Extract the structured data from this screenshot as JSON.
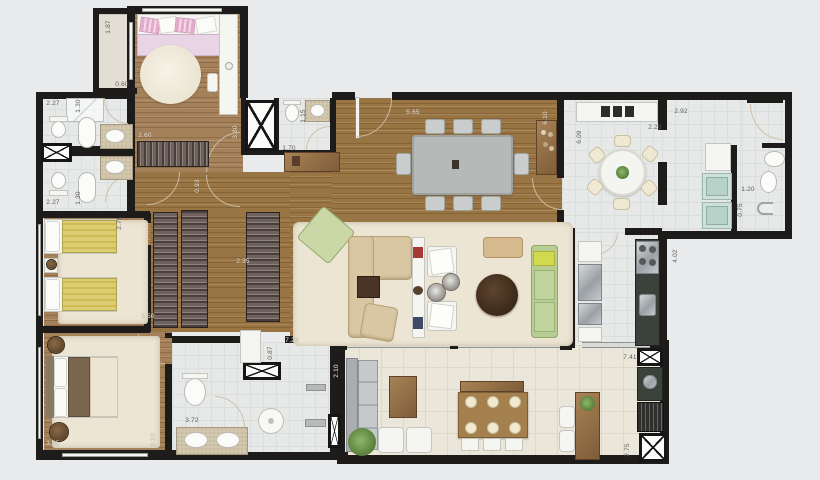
{
  "plan": {
    "title": "apartment-floor-plan-top-view",
    "palette": {
      "background": "#e9eaec",
      "wall": "#1d1c1a",
      "wood_floor": "#9a7544",
      "wood_floor_light": "#a5815a",
      "white_tile": "#e7e9e8",
      "terrace_tile": "#eae6da",
      "rug": "#ece5d4",
      "sofa_beige": "#d9c7a3",
      "sofa_green": "#b7cd92",
      "accent_yellow_blanket": "#dccc72",
      "accent_pink_blanket": "#e8d4e4",
      "counter_dark_granite": "#3b423b",
      "washer_teal": "#cfe0da",
      "wood_furniture": "#a07b4c"
    },
    "dimension_labels": [
      {
        "text": "1.87",
        "x": 109,
        "y": 27,
        "rot": "v",
        "on_dark": false
      },
      {
        "text": "0.60",
        "x": 122,
        "y": 85,
        "rot": "h",
        "on_dark": false
      },
      {
        "text": "2.27",
        "x": 53,
        "y": 104,
        "rot": "h",
        "on_dark": false
      },
      {
        "text": "1.30",
        "x": 79,
        "y": 106,
        "rot": "v",
        "on_dark": false
      },
      {
        "text": "2.60",
        "x": 145,
        "y": 136,
        "rot": "h",
        "on_dark": true
      },
      {
        "text": "3.80",
        "x": 236,
        "y": 132,
        "rot": "v",
        "on_dark": true
      },
      {
        "text": "0.93",
        "x": 198,
        "y": 186,
        "rot": "v",
        "on_dark": true
      },
      {
        "text": "2.27",
        "x": 53,
        "y": 203,
        "rot": "h",
        "on_dark": false
      },
      {
        "text": "1.30",
        "x": 79,
        "y": 198,
        "rot": "v",
        "on_dark": false
      },
      {
        "text": "2.71",
        "x": 120,
        "y": 223,
        "rot": "v",
        "on_dark": false
      },
      {
        "text": "2.35",
        "x": 243,
        "y": 262,
        "rot": "h",
        "on_dark": true
      },
      {
        "text": "3.50",
        "x": 148,
        "y": 317,
        "rot": "h",
        "on_dark": true
      },
      {
        "text": "3.35",
        "x": 53,
        "y": 444,
        "rot": "h",
        "on_dark": true
      },
      {
        "text": "3.10",
        "x": 154,
        "y": 440,
        "rot": "v",
        "on_dark": true
      },
      {
        "text": "3.72",
        "x": 192,
        "y": 421,
        "rot": "h",
        "on_dark": false
      },
      {
        "text": "0.87",
        "x": 271,
        "y": 353,
        "rot": "v",
        "on_dark": false
      },
      {
        "text": "7.26",
        "x": 292,
        "y": 341,
        "rot": "h",
        "on_dark": true
      },
      {
        "text": "2.10",
        "x": 337,
        "y": 371,
        "rot": "v",
        "on_dark": true
      },
      {
        "text": "1.15",
        "x": 304,
        "y": 116,
        "rot": "v",
        "on_dark": false
      },
      {
        "text": "1.70",
        "x": 289,
        "y": 149,
        "rot": "h",
        "on_dark": false
      },
      {
        "text": "5.65",
        "x": 413,
        "y": 113,
        "rot": "h",
        "on_dark": true
      },
      {
        "text": "6.10",
        "x": 546,
        "y": 118,
        "rot": "v",
        "on_dark": true
      },
      {
        "text": "6.09",
        "x": 580,
        "y": 137,
        "rot": "v",
        "on_dark": false
      },
      {
        "text": "2.20",
        "x": 655,
        "y": 128,
        "rot": "h",
        "on_dark": false
      },
      {
        "text": "2.92",
        "x": 681,
        "y": 112,
        "rot": "h",
        "on_dark": false
      },
      {
        "text": "1.20",
        "x": 748,
        "y": 190,
        "rot": "h",
        "on_dark": false
      },
      {
        "text": "0.75",
        "x": 741,
        "y": 210,
        "rot": "v",
        "on_dark": false
      },
      {
        "text": "4.02",
        "x": 676,
        "y": 256,
        "rot": "v",
        "on_dark": false
      },
      {
        "text": "7.41",
        "x": 630,
        "y": 358,
        "rot": "h",
        "on_dark": false
      },
      {
        "text": "2.75",
        "x": 628,
        "y": 450,
        "rot": "v",
        "on_dark": false
      }
    ]
  }
}
